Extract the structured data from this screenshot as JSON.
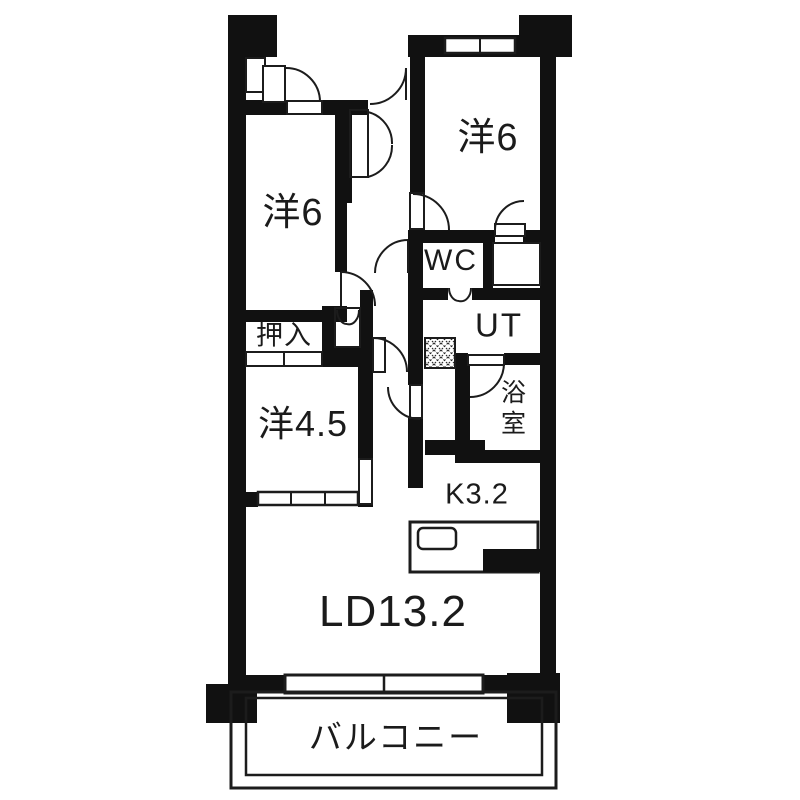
{
  "app": {
    "type": "apartment-floor-plan"
  },
  "colors": {
    "wall": "#111111",
    "line": "#1c1c1c",
    "bg": "#ffffff"
  },
  "rooms": {
    "bedroom_right": {
      "label": "洋6"
    },
    "bedroom_left": {
      "label": "洋6"
    },
    "wc": {
      "label": "WC"
    },
    "utility": {
      "label": "UT"
    },
    "bath": {
      "label": "浴室"
    },
    "closet": {
      "label": "押入"
    },
    "bedroom_small": {
      "label": "洋4.5"
    },
    "kitchen": {
      "label": "K3.2"
    },
    "living_dining": {
      "label": "LD13.2"
    },
    "balcony": {
      "label": "バルコニー"
    }
  }
}
